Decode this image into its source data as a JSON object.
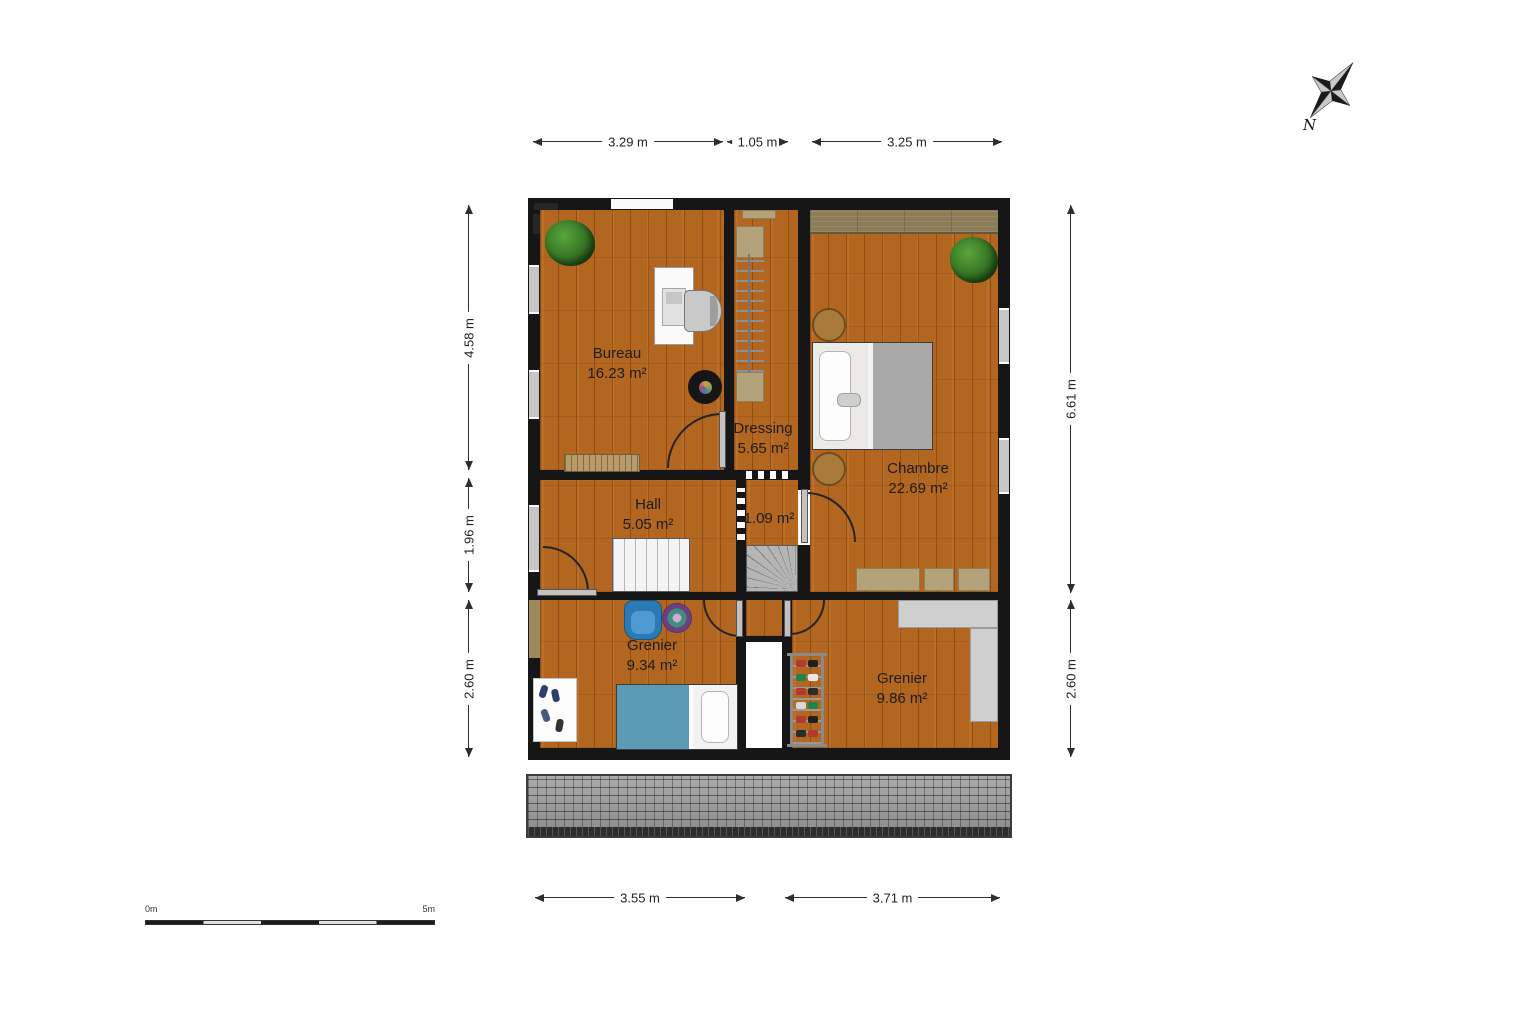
{
  "plan": {
    "rooms": [
      {
        "id": "bureau",
        "name": "Bureau",
        "area": "16.23 m²"
      },
      {
        "id": "dressing",
        "name": "Dressing",
        "area": "5.65 m²"
      },
      {
        "id": "chambre",
        "name": "Chambre",
        "area": "22.69 m²"
      },
      {
        "id": "hall",
        "name": "Hall",
        "area": "5.05 m²"
      },
      {
        "id": "stairwell",
        "name": "",
        "area": "1.09 m²"
      },
      {
        "id": "grenier-1",
        "name": "Grenier",
        "area": "9.34 m²"
      },
      {
        "id": "grenier-2",
        "name": "Grenier",
        "area": "9.86 m²"
      }
    ],
    "dimensions": {
      "top": [
        "3.29 m",
        "1.05 m",
        "3.25 m"
      ],
      "left": [
        "4.58 m",
        "1.96 m",
        "2.60 m"
      ],
      "right": [
        "6.61 m",
        "2.60 m"
      ],
      "bottom": [
        "3.55 m",
        "3.71 m"
      ]
    },
    "compass": {
      "north_label": "N"
    },
    "scale_bar": {
      "start_label": "0m",
      "end_label": "5m"
    }
  },
  "colors": {
    "wall": "#161616",
    "wood_floor": "#b2661f",
    "roof_tiles": "#9c9c9c",
    "wardrobe_band": "#8d7c58",
    "duvet_gray": "#a9a9a9",
    "duvet_blue": "#5b9bb5",
    "chair_blue": "#2a7ab5"
  }
}
